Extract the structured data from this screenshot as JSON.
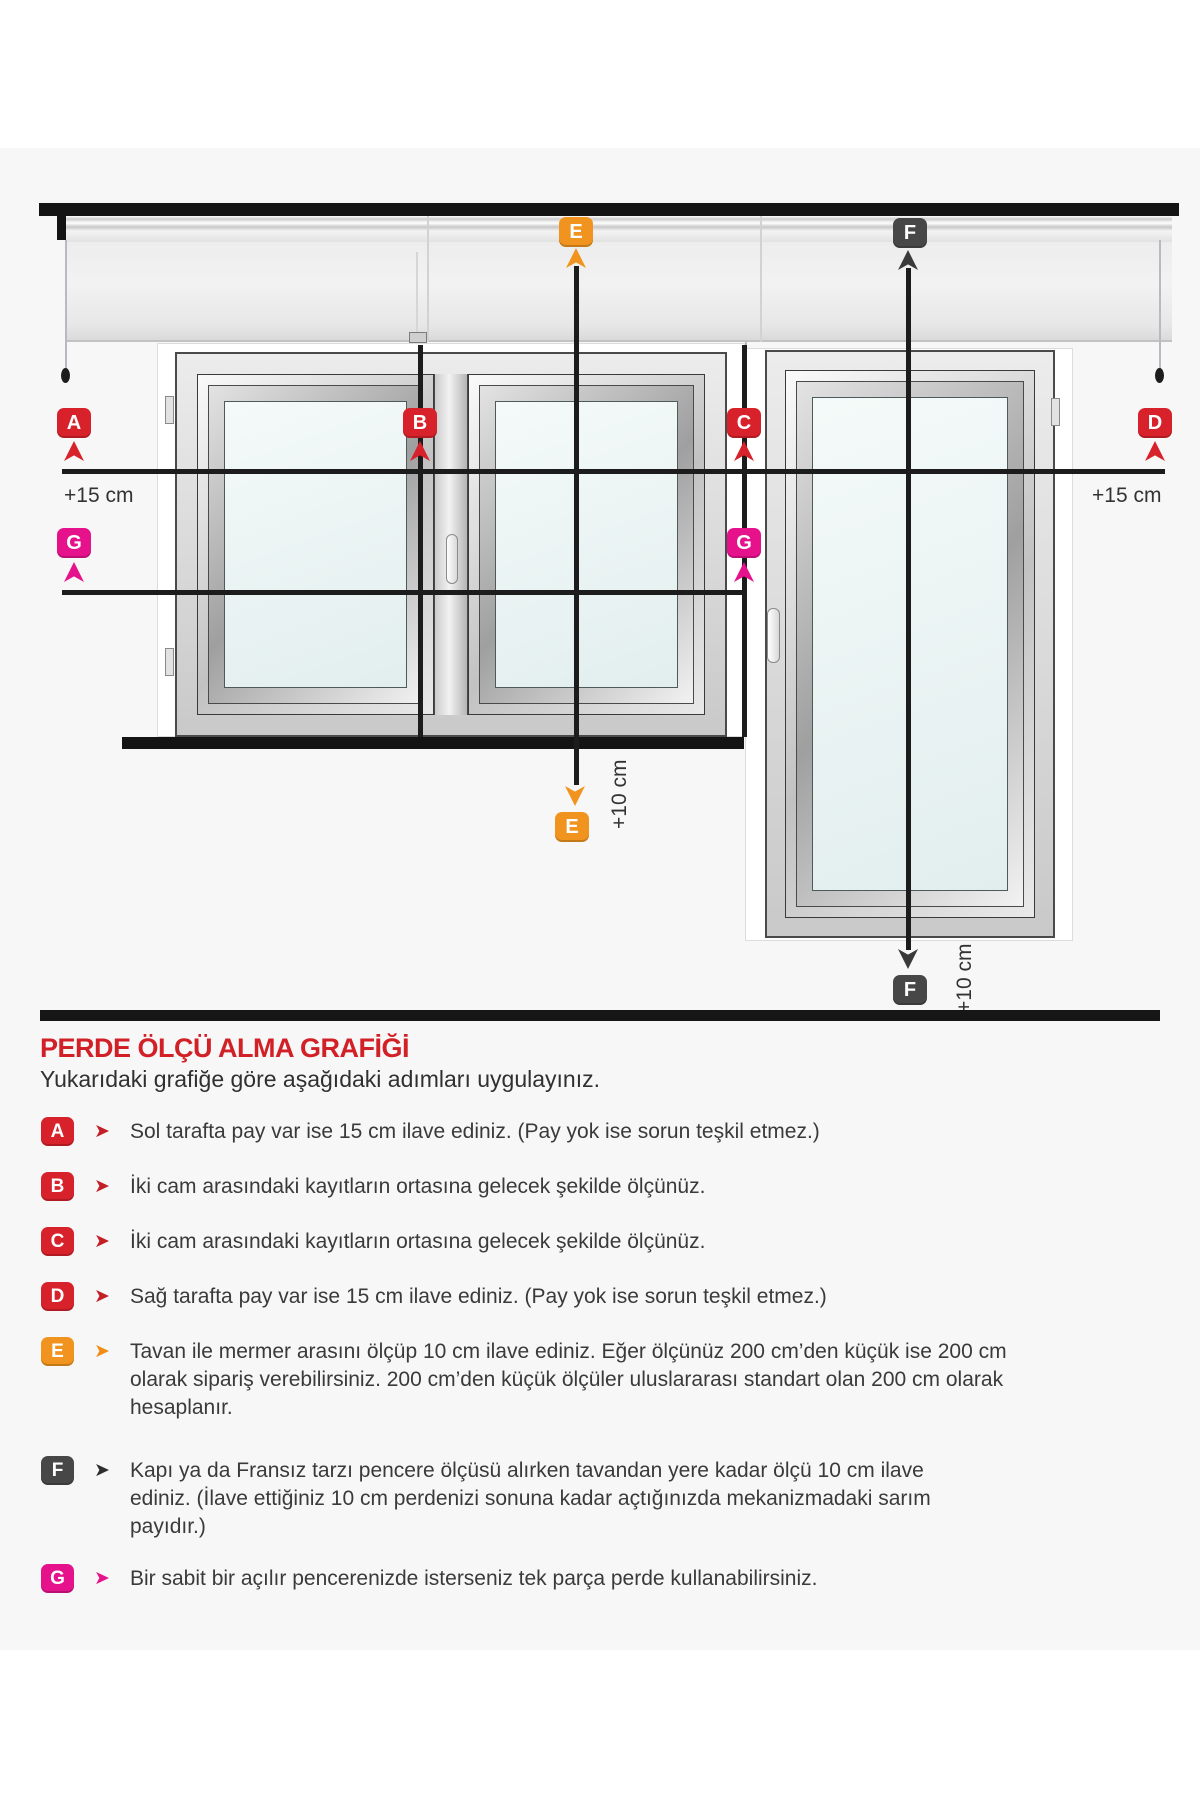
{
  "diagram": {
    "markers": {
      "a": "A",
      "b": "B",
      "c": "C",
      "d": "D",
      "e": "E",
      "f": "F",
      "g": "G"
    },
    "marker_colors": {
      "red": "#d7222b",
      "orange": "#f0941f",
      "dark": "#474747",
      "magenta": "#e5128c"
    },
    "annotations": {
      "plus15_left": "+15 cm",
      "plus15_right": "+15 cm",
      "plus10_e": "+10 cm",
      "plus10_f": "+10 cm"
    }
  },
  "legend": {
    "title": "PERDE ÖLÇÜ ALMA GRAFİĞİ",
    "subtitle": "Yukarıdaki grafiğe göre aşağıdaki adımları uygulayınız.",
    "title_color": "#d22027",
    "arrow_glyph": "➤",
    "items": [
      {
        "letter": "A",
        "color": "#d7222b",
        "text": "Sol tarafta pay var ise 15 cm ilave ediniz. (Pay yok ise sorun teşkil etmez.)"
      },
      {
        "letter": "B",
        "color": "#d7222b",
        "text": "İki cam arasındaki kayıtların ortasına gelecek şekilde ölçünüz."
      },
      {
        "letter": "C",
        "color": "#d7222b",
        "text": "İki cam arasındaki kayıtların ortasına gelecek şekilde ölçünüz."
      },
      {
        "letter": "D",
        "color": "#d7222b",
        "text": "Sağ tarafta pay var ise 15 cm ilave ediniz. (Pay yok ise sorun teşkil etmez.)"
      },
      {
        "letter": "E",
        "color": "#f0941f",
        "text": "Tavan ile mermer arasını ölçüp 10 cm ilave ediniz. Eğer ölçünüz 200 cm’den küçük ise 200 cm olarak sipariş verebilirsiniz. 200 cm’den küçük ölçüler uluslararası standart olan 200 cm olarak hesaplanır."
      },
      {
        "letter": "F",
        "color": "#474747",
        "text": "Kapı ya da Fransız tarzı pencere ölçüsü alırken tavandan yere kadar ölçü 10 cm ilave ediniz. (İlave ettiğiniz 10 cm perdenizi sonuna kadar açtığınızda mekanizmadaki sarım payıdır.)"
      },
      {
        "letter": "G",
        "color": "#e5128c",
        "text": "Bir sabit bir açılır pencerenizde isterseniz tek parça perde kullanabilirsiniz."
      }
    ]
  }
}
